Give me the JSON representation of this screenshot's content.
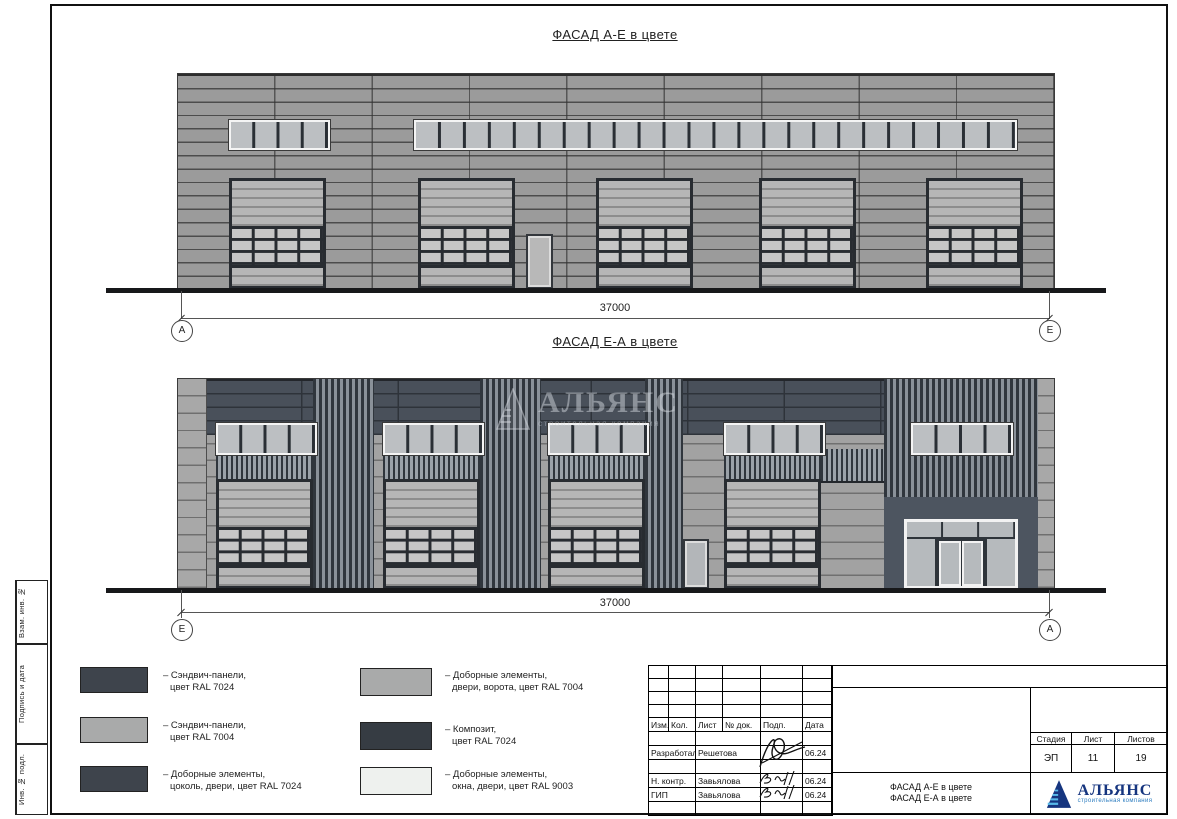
{
  "sheet_side_labels": {
    "label1": "Взам. инв. №",
    "label2": "Подпись и дата",
    "label3": "Инв. № подл."
  },
  "elevation_top": {
    "title": "ФАСАД А-Е в цвете",
    "dimension": "37000",
    "axis_left": "А",
    "axis_right": "Е"
  },
  "elevation_bottom": {
    "title": "ФАСАД Е-А в цвете",
    "dimension": "37000",
    "axis_left": "Е",
    "axis_right": "А"
  },
  "watermark": {
    "name": "АЛЬЯНС",
    "tagline": "строительная компания"
  },
  "legend": [
    {
      "color": "#3e444c",
      "line1": "– Сэндвич-панели,",
      "line2": "цвет RAL 7024"
    },
    {
      "color": "#a9aaaa",
      "line1": "– Сэндвич-панели,",
      "line2": "цвет RAL 7004"
    },
    {
      "color": "#3e444c",
      "line1": "– Доборные элементы,",
      "line2": "цоколь, двери, цвет RAL 7024"
    },
    {
      "color": "#a9aaaa",
      "line1": "– Доборные элементы,",
      "line2": "двери, ворота, цвет RAL 7004"
    },
    {
      "color": "#363c43",
      "line1": "– Композит,",
      "line2": "цвет RAL 7024"
    },
    {
      "color": "#eef1ee",
      "line1": "– Доборные элементы,",
      "line2": "окна, двери, цвет RAL 9003"
    }
  ],
  "title_block": {
    "header": [
      "Изм.",
      "Кол.",
      "Лист",
      "№ док.",
      "Подп.",
      "Дата"
    ],
    "rows": [
      {
        "role": "Разработал",
        "name": "Решетова",
        "date": "06.24"
      },
      {
        "role": "Н. контр.",
        "name": "Завьялова",
        "date": "06.24"
      },
      {
        "role": "ГИП",
        "name": "Завьялова",
        "date": "06.24"
      }
    ],
    "stage_label": "Стадия",
    "sheet_label": "Лист",
    "sheets_label": "Листов",
    "stage_value": "ЭП",
    "sheet_value": "11",
    "sheets_value": "19",
    "doc_title1": "ФАСАД А-Е в цвете",
    "doc_title2": "ФАСАД Е-А в цвете",
    "logo_name": "АЛЬЯНС",
    "logo_tagline": "строительная компания"
  }
}
